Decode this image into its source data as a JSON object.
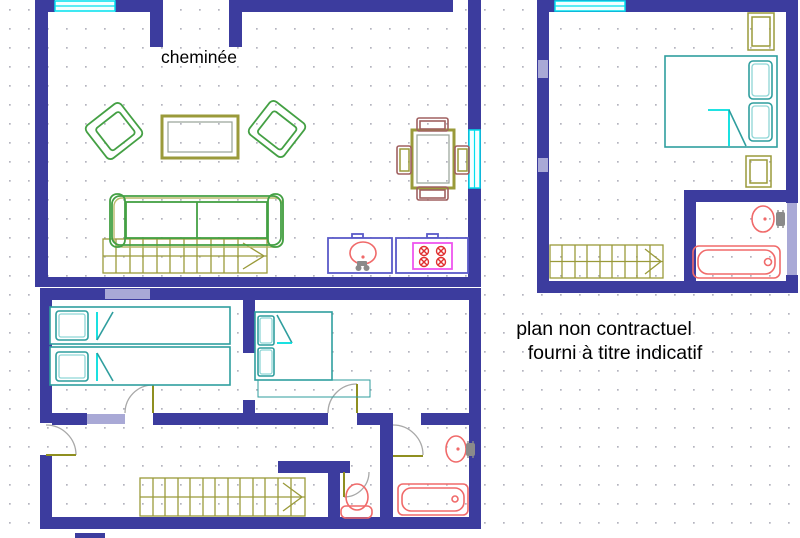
{
  "texts": {
    "fireplace_label": "cheminée",
    "disclaimer_line1": "plan non contractuel",
    "disclaimer_line2": "fourni à titre indicatif"
  },
  "colors": {
    "wall": "#3c3c9e",
    "wall_light": "#a9a9d6",
    "window": "#00e0ee",
    "furniture_green": "#44a044",
    "wood_olive": "#9a9a3a",
    "door_leaf": "#8f8f20",
    "door_arc": "#a8a8a8",
    "bed_teal": "#2f9e9e",
    "bed_fold_cyan": "#00dede",
    "fixture_red": "#f06a6a",
    "counter_blue": "#5a5ac8",
    "stove_magenta": "#ee55ee",
    "burner_red": "#e03030",
    "metal_gray": "#8a8a8a",
    "text": "#000000",
    "grid_dot": "#b4b4be",
    "background": "#ffffff"
  }
}
